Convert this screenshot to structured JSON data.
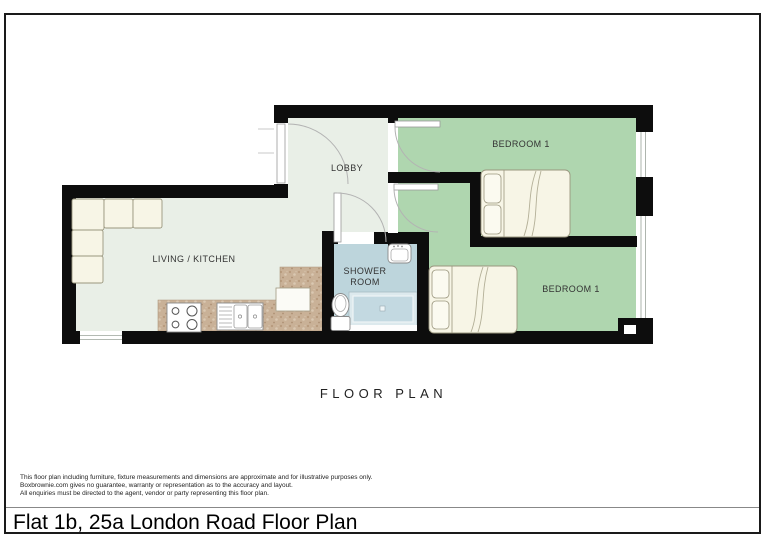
{
  "document": {
    "plan_heading": "FLOOR PLAN",
    "title": "Flat 1b, 25a London Road Floor Plan",
    "disclaimer_lines": [
      "This floor plan including furniture, fixture measurements and dimensions are approximate and for illustrative purposes only.",
      "Boxbrownie.com gives no guarantee, warranty or representation as to the accuracy and layout.",
      "All enquiries must be directed to the agent, vendor or party representing this floor plan."
    ]
  },
  "rooms": {
    "living_kitchen": "LIVING / KITCHEN",
    "lobby": "LOBBY",
    "bedroom_top": "BEDROOM 1",
    "bedroom_bottom": "BEDROOM 1",
    "shower_line1": "SHOWER",
    "shower_line2": "ROOM"
  },
  "colors": {
    "wall": "#0d0d0d",
    "floor_main": "#e9efe7",
    "floor_bedroom": "#afd6af",
    "floor_shower": "#bdd5dc",
    "shower_tray": "#c3d9e1",
    "kitchen_counter": "#c9b197",
    "furniture": "#f7f5e6"
  }
}
